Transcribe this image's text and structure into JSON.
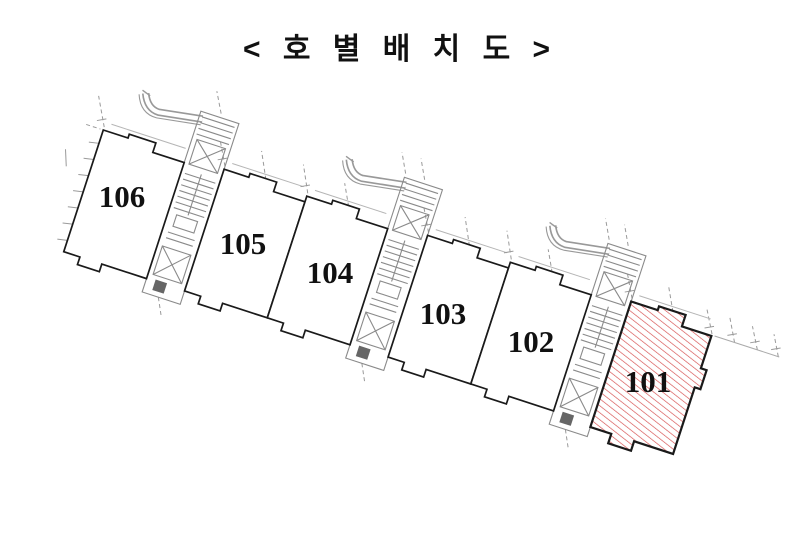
{
  "title": "< 호 별 배 치 도 >",
  "plan": {
    "units": [
      {
        "label": "106",
        "highlighted": false
      },
      {
        "label": "105",
        "highlighted": false
      },
      {
        "label": "104",
        "highlighted": false
      },
      {
        "label": "103",
        "highlighted": false
      },
      {
        "label": "102",
        "highlighted": false
      },
      {
        "label": "101",
        "highlighted": true
      }
    ],
    "colors": {
      "outline": "#1a1a1a",
      "unit_label": "#111111",
      "highlight_hatch": "#d54c4c",
      "highlight_label": "#cc2020",
      "stair_detail": "#8a8a8a",
      "dimension_guides": "#9a9a9a",
      "background": "#ffffff"
    }
  }
}
